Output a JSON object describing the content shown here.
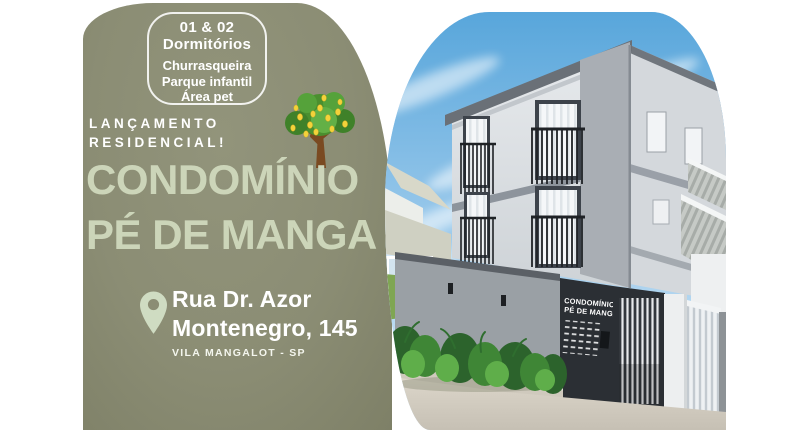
{
  "flyer": {
    "badge": {
      "rooms_line1": "01 & 02",
      "rooms_line2": "Dormitórios",
      "features": [
        "Churrasqueira",
        "Parque infantil",
        "Área pet"
      ]
    },
    "launch_line1": "LANÇAMENTO",
    "launch_line2": "RESIDENCIAL!",
    "title_line1": "CONDOMÍNIO",
    "title_line2": "PÉ DE MANGA",
    "address": {
      "street_line1": "Rua Dr. Azor",
      "street_line2": "Montenegro, 145",
      "district": "VILA MANGALOT - SP"
    }
  },
  "photo": {
    "building_sign_line1": "CONDOMÍNIO",
    "building_sign_line2": "PÉ DE MANGA"
  },
  "icons": {
    "tree": "mango-tree-icon",
    "pin": "location-pin-icon"
  },
  "colors": {
    "olive_background": "#8C8E75",
    "pale_sage_text": "#CCD5B9",
    "white_text": "#FFFFFF",
    "sky_top": "#58A6DB",
    "sky_bottom": "#CBE3F4",
    "sign_panel": "#2C3036",
    "facade_light": "#E3E6E9",
    "facade_speckle": "#A9AEB4"
  }
}
